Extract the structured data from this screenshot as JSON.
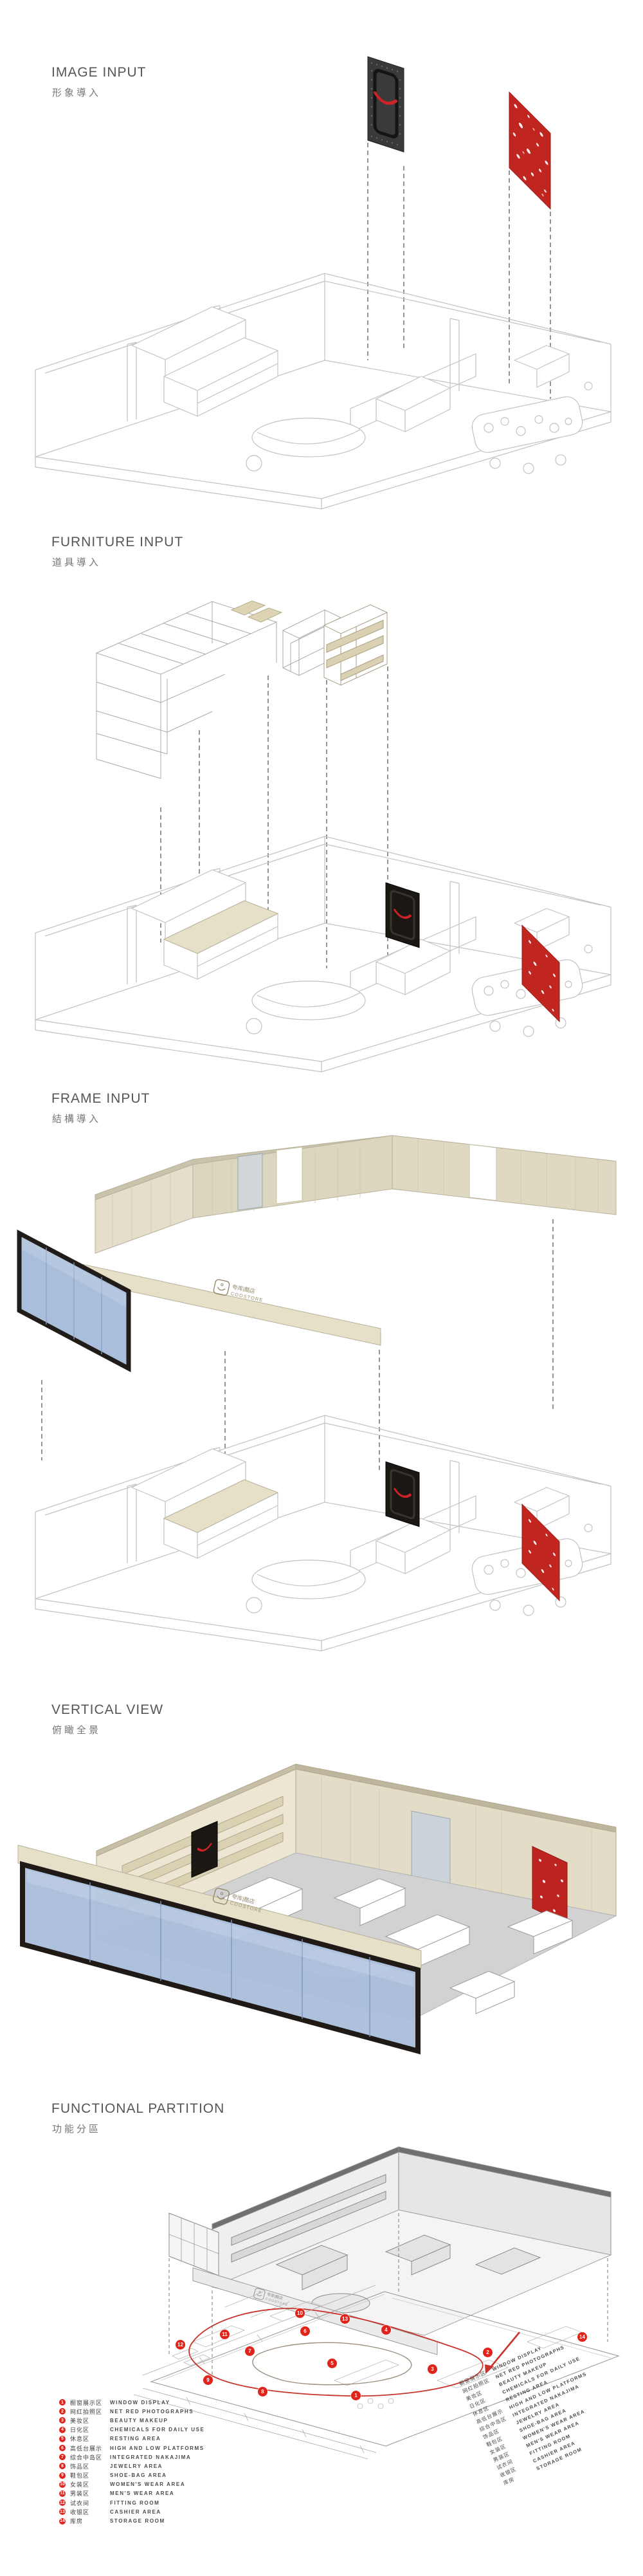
{
  "brand": {
    "logo_text": "COOSTORE",
    "logo_zh": "夸库|酷店"
  },
  "colors": {
    "accent_red": "#c0261f",
    "badge_red": "#e0241b",
    "wood": "#e4decb",
    "glass_blue": "#a9bedb",
    "frame_dark": "#211c18",
    "wireframe": "#c2c2c2",
    "model_gray": "#e6e6e6",
    "title_gray": "#55565a"
  },
  "sections": [
    {
      "id": "image-input",
      "title_en": "IMAGE INPUT",
      "title_zh": "形象導入"
    },
    {
      "id": "furniture-input",
      "title_en": "FURNITURE INPUT",
      "title_zh": "道具導入"
    },
    {
      "id": "frame-input",
      "title_en": "FRAME INPUT",
      "title_zh": "結構導入"
    },
    {
      "id": "vertical-view",
      "title_en": "VERTICAL VIEW",
      "title_zh": "俯瞰全景"
    },
    {
      "id": "functional-partition",
      "title_en": "FUNCTIONAL PARTITION",
      "title_zh": "功能分區"
    }
  ],
  "legend": {
    "items": [
      {
        "num": "1",
        "zh": "橱窗展示区",
        "en": "WINDOW DISPLAY"
      },
      {
        "num": "2",
        "zh": "网红拍照区",
        "en": "NET RED PHOTOGRAPHS"
      },
      {
        "num": "3",
        "zh": "美妆区",
        "en": "BEAUTY MAKEUP"
      },
      {
        "num": "4",
        "zh": "日化区",
        "en": "CHEMICALS FOR DAILY USE"
      },
      {
        "num": "5",
        "zh": "休息区",
        "en": "RESTING AREA"
      },
      {
        "num": "6",
        "zh": "高低台展示",
        "en": "HIGH AND LOW PLATFORMS"
      },
      {
        "num": "7",
        "zh": "综合中岛区",
        "en": "INTEGRATED NAKAJIMA"
      },
      {
        "num": "8",
        "zh": "饰品区",
        "en": "JEWELRY AREA"
      },
      {
        "num": "9",
        "zh": "鞋包区",
        "en": "SHOE-BAG AREA"
      },
      {
        "num": "10",
        "zh": "女装区",
        "en": "WOMEN'S WEAR AREA"
      },
      {
        "num": "11",
        "zh": "男装区",
        "en": "MEN'S WEAR AREA"
      },
      {
        "num": "12",
        "zh": "试衣间",
        "en": "FITTING ROOM"
      },
      {
        "num": "13",
        "zh": "收银区",
        "en": "CASHIER AREA"
      },
      {
        "num": "14",
        "zh": "库房",
        "en": "STORAGE ROOM"
      }
    ]
  }
}
